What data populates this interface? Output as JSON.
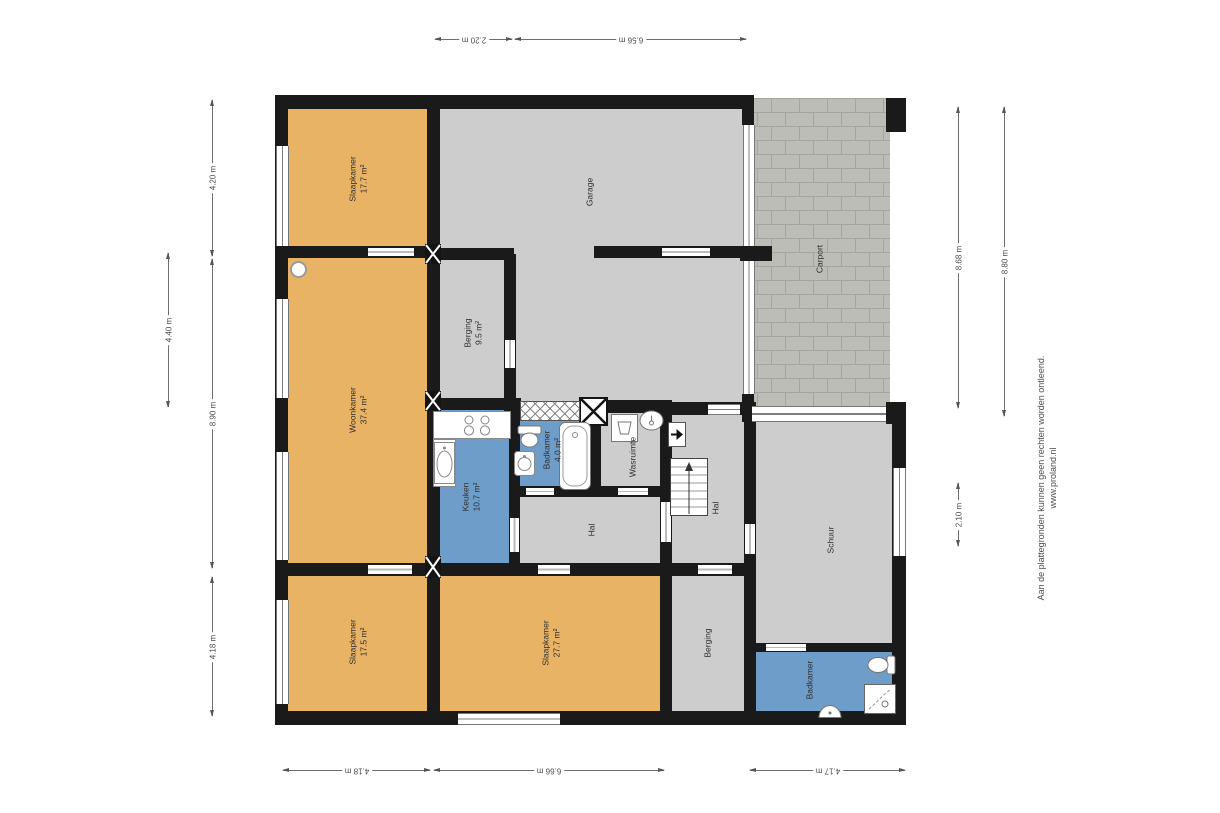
{
  "rooms": [
    {
      "name": "Slaapkamer",
      "area": "17.7 m²"
    },
    {
      "name": "Woonkamer",
      "area": "37.4 m²"
    },
    {
      "name": "Slaapkamer",
      "area": "17.5 m²"
    },
    {
      "name": "Slaapkamer",
      "area": "27.7 m²"
    },
    {
      "name": "Garage",
      "area": ""
    },
    {
      "name": "Berging",
      "area": "9.5 m²"
    },
    {
      "name": "Keuken",
      "area": "10.7 m²"
    },
    {
      "name": "Badkamer",
      "area": "4.0 m²"
    },
    {
      "name": "Wasruimte",
      "area": ""
    },
    {
      "name": "Hal",
      "area": ""
    },
    {
      "name": "Hal",
      "area": ""
    },
    {
      "name": "Berging",
      "area": ""
    },
    {
      "name": "Schuur",
      "area": ""
    },
    {
      "name": "Badkamer",
      "area": ""
    },
    {
      "name": "Carport",
      "area": ""
    }
  ],
  "dimensions": {
    "top": [
      "2.20 m",
      "6.56 m"
    ],
    "bottom": [
      "4.18 m",
      "6.66 m",
      "4.17 m"
    ],
    "left_outer": [
      "4.20 m",
      "8.90 m",
      "4.18 m"
    ],
    "left_inner": [
      "4.40 m"
    ],
    "right_inner": [
      "8.68 m",
      "2.10 m"
    ],
    "right_outer": [
      "8.80 m"
    ]
  },
  "watermark": {
    "disclaimer": "Aan de plattegronden kunnen geen rechten worden ontleend.",
    "website": "www.proland.nl"
  },
  "colors": {
    "room_fill_orange": "#e9b366",
    "room_fill_gray": "#cdcdcd",
    "room_fill_blue": "#6e9dc9",
    "wall": "#1a1a1a",
    "carport_paving": "#bdbdb7"
  }
}
